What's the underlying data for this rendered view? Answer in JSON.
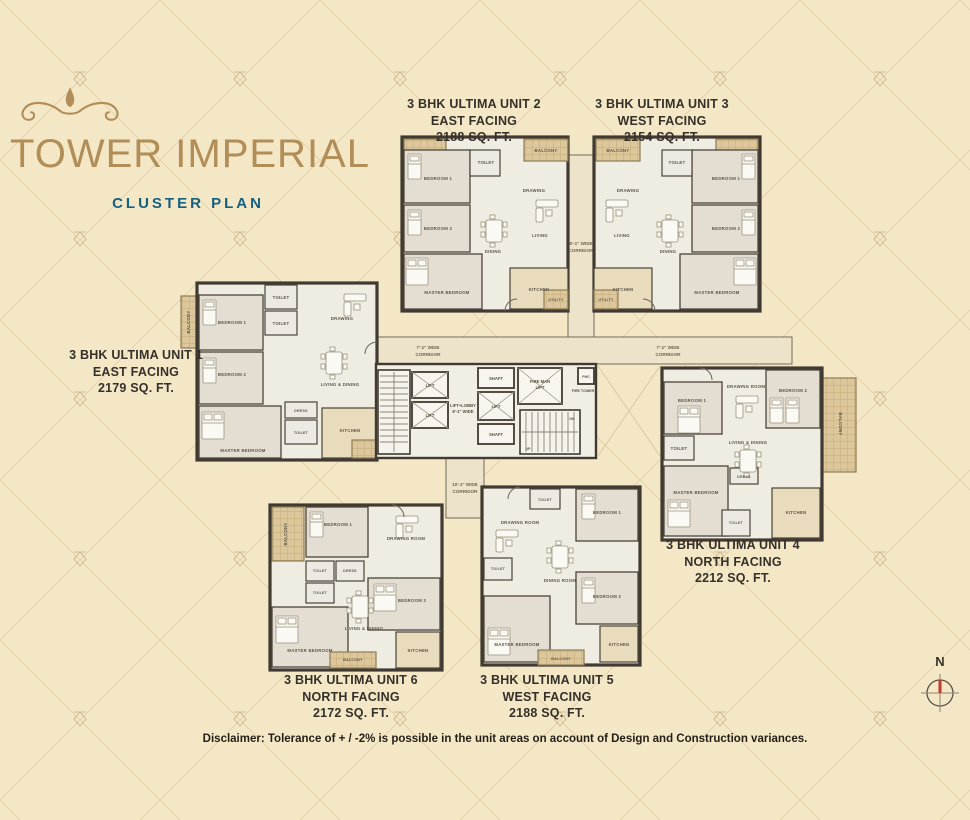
{
  "header": {
    "title": "TOWER IMPERIAL",
    "subtitle": "CLUSTER PLAN"
  },
  "units": [
    {
      "name": "3 BHK ULTIMA UNIT 1",
      "facing": "EAST FACING",
      "area": "2179 SQ. FT."
    },
    {
      "name": "3 BHK ULTIMA UNIT 2",
      "facing": "EAST FACING",
      "area": "2188 SQ. FT."
    },
    {
      "name": "3 BHK ULTIMA UNIT 3",
      "facing": "WEST FACING",
      "area": "2154 SQ. FT."
    },
    {
      "name": "3 BHK ULTIMA UNIT 4",
      "facing": "NORTH FACING",
      "area": "2212 SQ. FT."
    },
    {
      "name": "3 BHK ULTIMA UNIT 5",
      "facing": "WEST FACING",
      "area": "2188 SQ. FT."
    },
    {
      "name": "3 BHK ULTIMA UNIT 6",
      "facing": "NORTH FACING",
      "area": "2172 SQ. FT."
    }
  ],
  "plan": {
    "corridors": {
      "west_l1": "7'-1\" WIDE",
      "west_l2": "CORRIDOR",
      "east_l1": "7'-1\" WIDE",
      "east_l2": "CORRIDOR",
      "north_l1": "6'-1\" WIDE",
      "north_l2": "CORRIDOR",
      "south_l1": "10'-1\" WIDE",
      "south_l2": "CORRIDOR",
      "lobby_l1": "LIFT+LOBBY",
      "lobby_l2": "8'-1\" WIDE"
    },
    "core": {
      "lift": "LIFT",
      "fireman_l1": "FIRE MAN",
      "fireman_l2": "LIFT",
      "shaft": "SHAFT",
      "fire_tower": "FIRE TOWER",
      "fhc": "FHC",
      "up": "UP",
      "dn": "DN"
    },
    "rooms": {
      "bedroom1": "BEDROOM 1",
      "bedroom2": "BEDROOM 2",
      "master_bedroom": "MASTER BEDROOM",
      "toilet": "TOILET",
      "dress": "DRESS",
      "drawing": "DRAWING",
      "drawing_room": "DRAWING ROOM",
      "living": "LIVING",
      "dining": "DINING",
      "living_dining": "LIVING & DINING",
      "dining_room": "DINING ROOM",
      "kitchen": "KITCHEN",
      "balcony": "BALCONY",
      "utility": "UTILITY"
    }
  },
  "disclaimer": "Disclaimer: Tolerance of + / -2% is possible in the unit areas on account of Design and Construction variances.",
  "compass": {
    "north": "N"
  },
  "colors": {
    "background": "#f4e7c6",
    "title_gold": "#b18d58",
    "subtitle_blue": "#15607f",
    "wall": "#403a32",
    "balcony_tan": "#dcc69b",
    "compass_red": "#c23b2a"
  }
}
